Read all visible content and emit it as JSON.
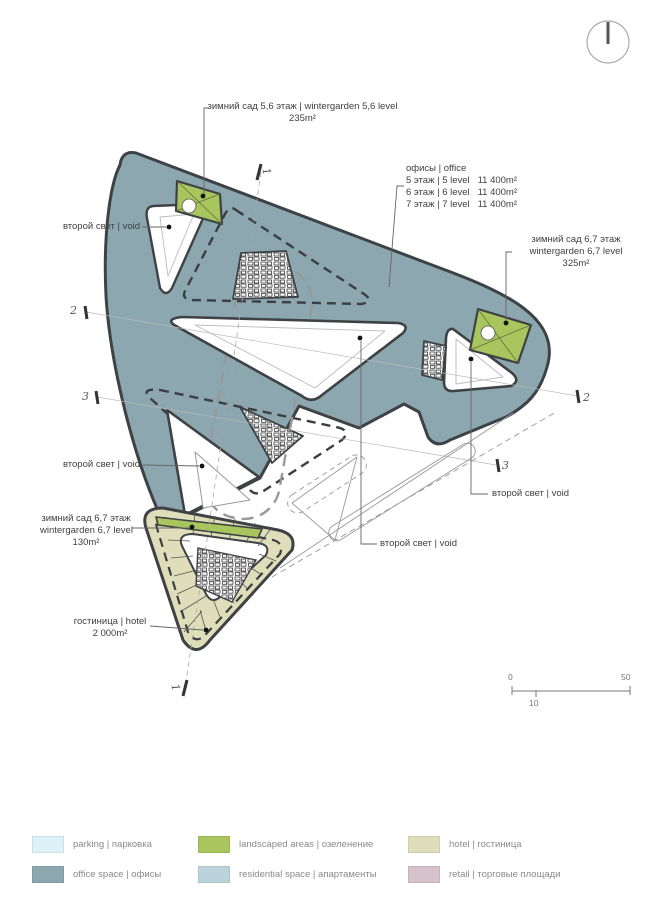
{
  "annotations": {
    "wg56": {
      "line1": "зимний сад  5,6 этаж | wintergarden 5,6 level",
      "line2": "235m²"
    },
    "office": {
      "title": "офисы | office",
      "rows": [
        "5 этаж | 5 level   11 400m²",
        "6 этаж | 6 level   11 400m²",
        "7 этаж | 7 level   11 400m²"
      ]
    },
    "wg67_right": {
      "line1": "зимний сад  6,7 этаж",
      "line2": "wintergarden 6,7 level",
      "line3": "325m²"
    },
    "void_top_left": "второй свет | void",
    "void_left": "второй свет | void",
    "wg67_left": {
      "line1": "зимний сад  6,7 этаж",
      "line2": "wintergarden 6,7 level",
      "line3": "130m²"
    },
    "hotel": {
      "line1": "гостиница | hotel",
      "line2": "2 000m²"
    },
    "void_right": "второй свет | void",
    "void_center": "второй свет | void"
  },
  "sections": {
    "s1": "1",
    "s2": "2",
    "s3": "3"
  },
  "scale_bar": {
    "start": "0",
    "mid": "10",
    "end": "50"
  },
  "legend": {
    "items": [
      {
        "label": "parking | парковка",
        "color": "#dcf2f8"
      },
      {
        "label": "office space | офисы",
        "color": "#8ca7b0"
      },
      {
        "label": "landscaped areas | озеленение",
        "color": "#a8c55e"
      },
      {
        "label": "residential space | апартаменты",
        "color": "#bcd3dc"
      },
      {
        "label": "hotel | гостиница",
        "color": "#dfdeba"
      },
      {
        "label": "retail | торговые площади",
        "color": "#d5c2ca"
      }
    ]
  },
  "colors": {
    "office_fill": "#8ca7b0",
    "landscaped_fill": "#a8c55e",
    "hotel_fill": "#dfdeba",
    "outline": "#3e4244",
    "leader": "#666666"
  }
}
